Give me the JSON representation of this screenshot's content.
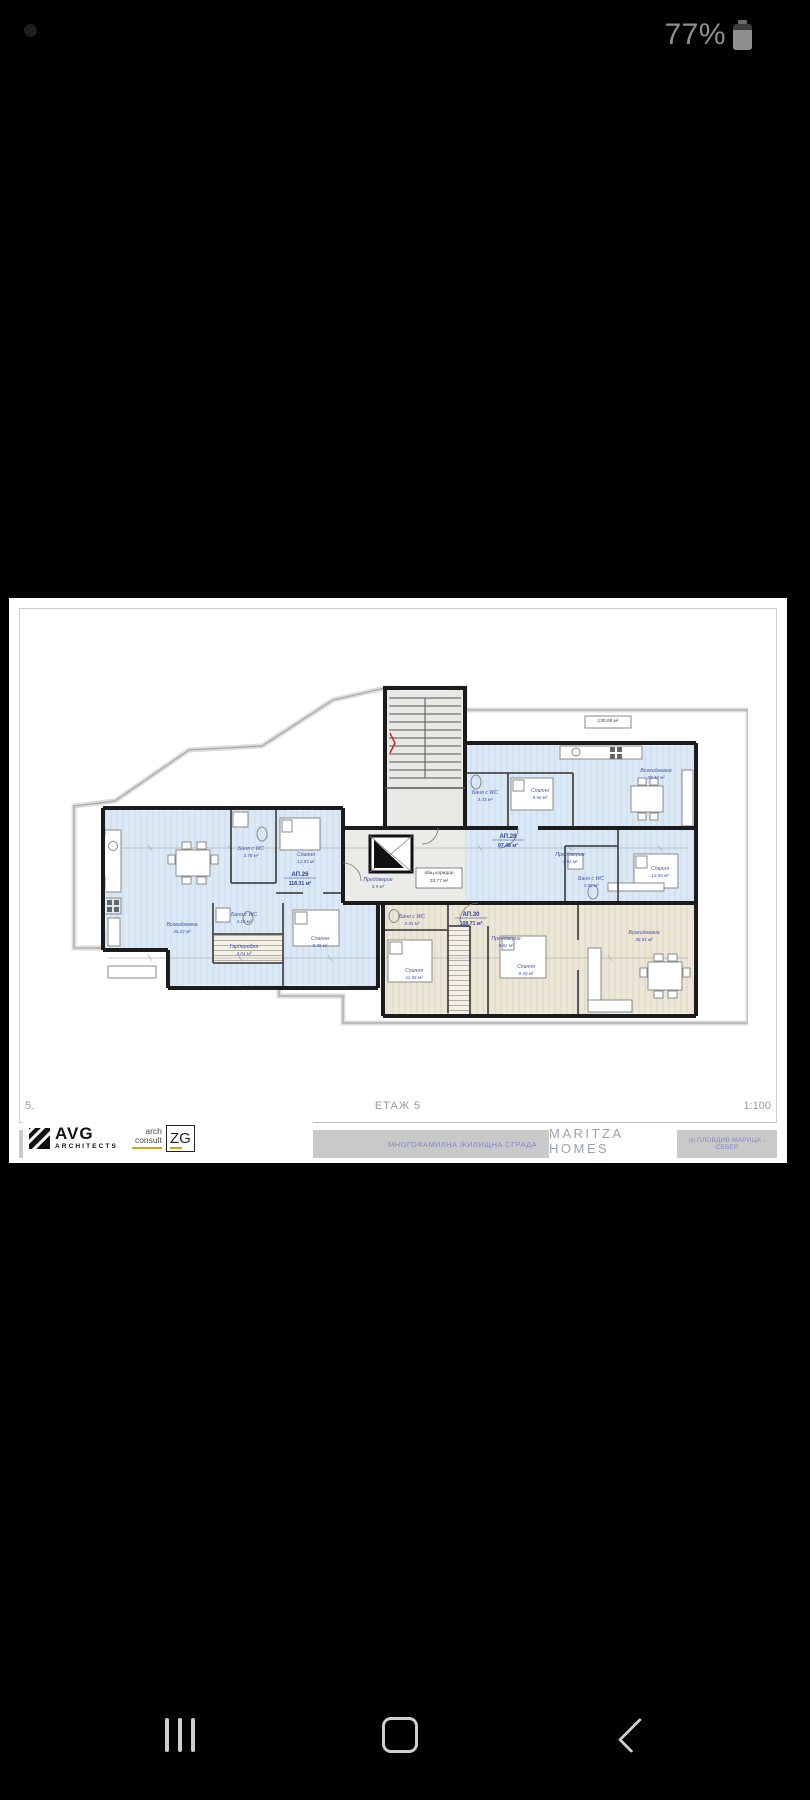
{
  "status_bar": {
    "battery_percent": "77%"
  },
  "sheet": {
    "number": "5.",
    "name": "ЕТАЖ 5",
    "scale": "1:100",
    "titleblock": {
      "project": "МНОГОФАМИЛНА ЖИЛИЩНА СГРАДА",
      "brand": "MARITZA HOMES",
      "location": "гр.ПЛОВДИВ МАРИЦА - СЕВЕР",
      "logo_avg": {
        "name": "AVG",
        "sub": "ARCHITECTS"
      },
      "logo_zg": {
        "top": "arch",
        "bottom": "consult",
        "mark": "ZG"
      }
    },
    "plan": {
      "boxed_labels": [
        {
          "x": 560,
          "y": 44,
          "lines": [
            "130.08 м²"
          ]
        },
        {
          "x": 391,
          "y": 196,
          "lines": [
            "общ.коридор",
            "33.77 м²"
          ]
        }
      ],
      "apartment_labels": [
        {
          "x": 252,
          "y": 198,
          "id": "АП.26",
          "area": "118.31 м²"
        },
        {
          "x": 460,
          "y": 160,
          "id": "АП.28",
          "area": "97.46 м²"
        },
        {
          "x": 423,
          "y": 238,
          "id": "АП.30",
          "area": "108.71 м²"
        }
      ],
      "room_labels": [
        {
          "x": 134,
          "y": 248,
          "name": "Всекидневна",
          "area": "36.22 м²"
        },
        {
          "x": 203,
          "y": 172,
          "name": "Баня с WC",
          "area": "3.78 м²"
        },
        {
          "x": 258,
          "y": 178,
          "name": "Спалня",
          "area": "12.91 м²"
        },
        {
          "x": 330,
          "y": 203,
          "name": "Преддверие",
          "area": "6.9 м²"
        },
        {
          "x": 196,
          "y": 238,
          "name": "Баня с WC",
          "area": "4.15 м²"
        },
        {
          "x": 196,
          "y": 270,
          "name": "Гардеробна",
          "area": "4.01 м²"
        },
        {
          "x": 272,
          "y": 262,
          "name": "Спалня",
          "area": "9.76 м²"
        },
        {
          "x": 608,
          "y": 94,
          "name": "Всекидневна",
          "area": "29.42 м²"
        },
        {
          "x": 492,
          "y": 114,
          "name": "Спалня",
          "area": "9.56 м²"
        },
        {
          "x": 437,
          "y": 116,
          "name": "Баня с WC",
          "area": "3.43 м²"
        },
        {
          "x": 522,
          "y": 178,
          "name": "Преддверие",
          "area": "4.92 м²"
        },
        {
          "x": 543,
          "y": 202,
          "name": "Баня с WC",
          "area": "3.93 м²"
        },
        {
          "x": 612,
          "y": 192,
          "name": "Спалня",
          "area": "13.89 м²"
        },
        {
          "x": 458,
          "y": 262,
          "name": "Преддверие",
          "area": "9.82 м²"
        },
        {
          "x": 364,
          "y": 240,
          "name": "Баня с WC",
          "area": "3.91 м²"
        },
        {
          "x": 366,
          "y": 294,
          "name": "Спалня",
          "area": "11.56 м²"
        },
        {
          "x": 478,
          "y": 290,
          "name": "Спалня",
          "area": "9.43 м²"
        },
        {
          "x": 596,
          "y": 256,
          "name": "Всекидневна",
          "area": "38.51 м²"
        }
      ]
    }
  }
}
